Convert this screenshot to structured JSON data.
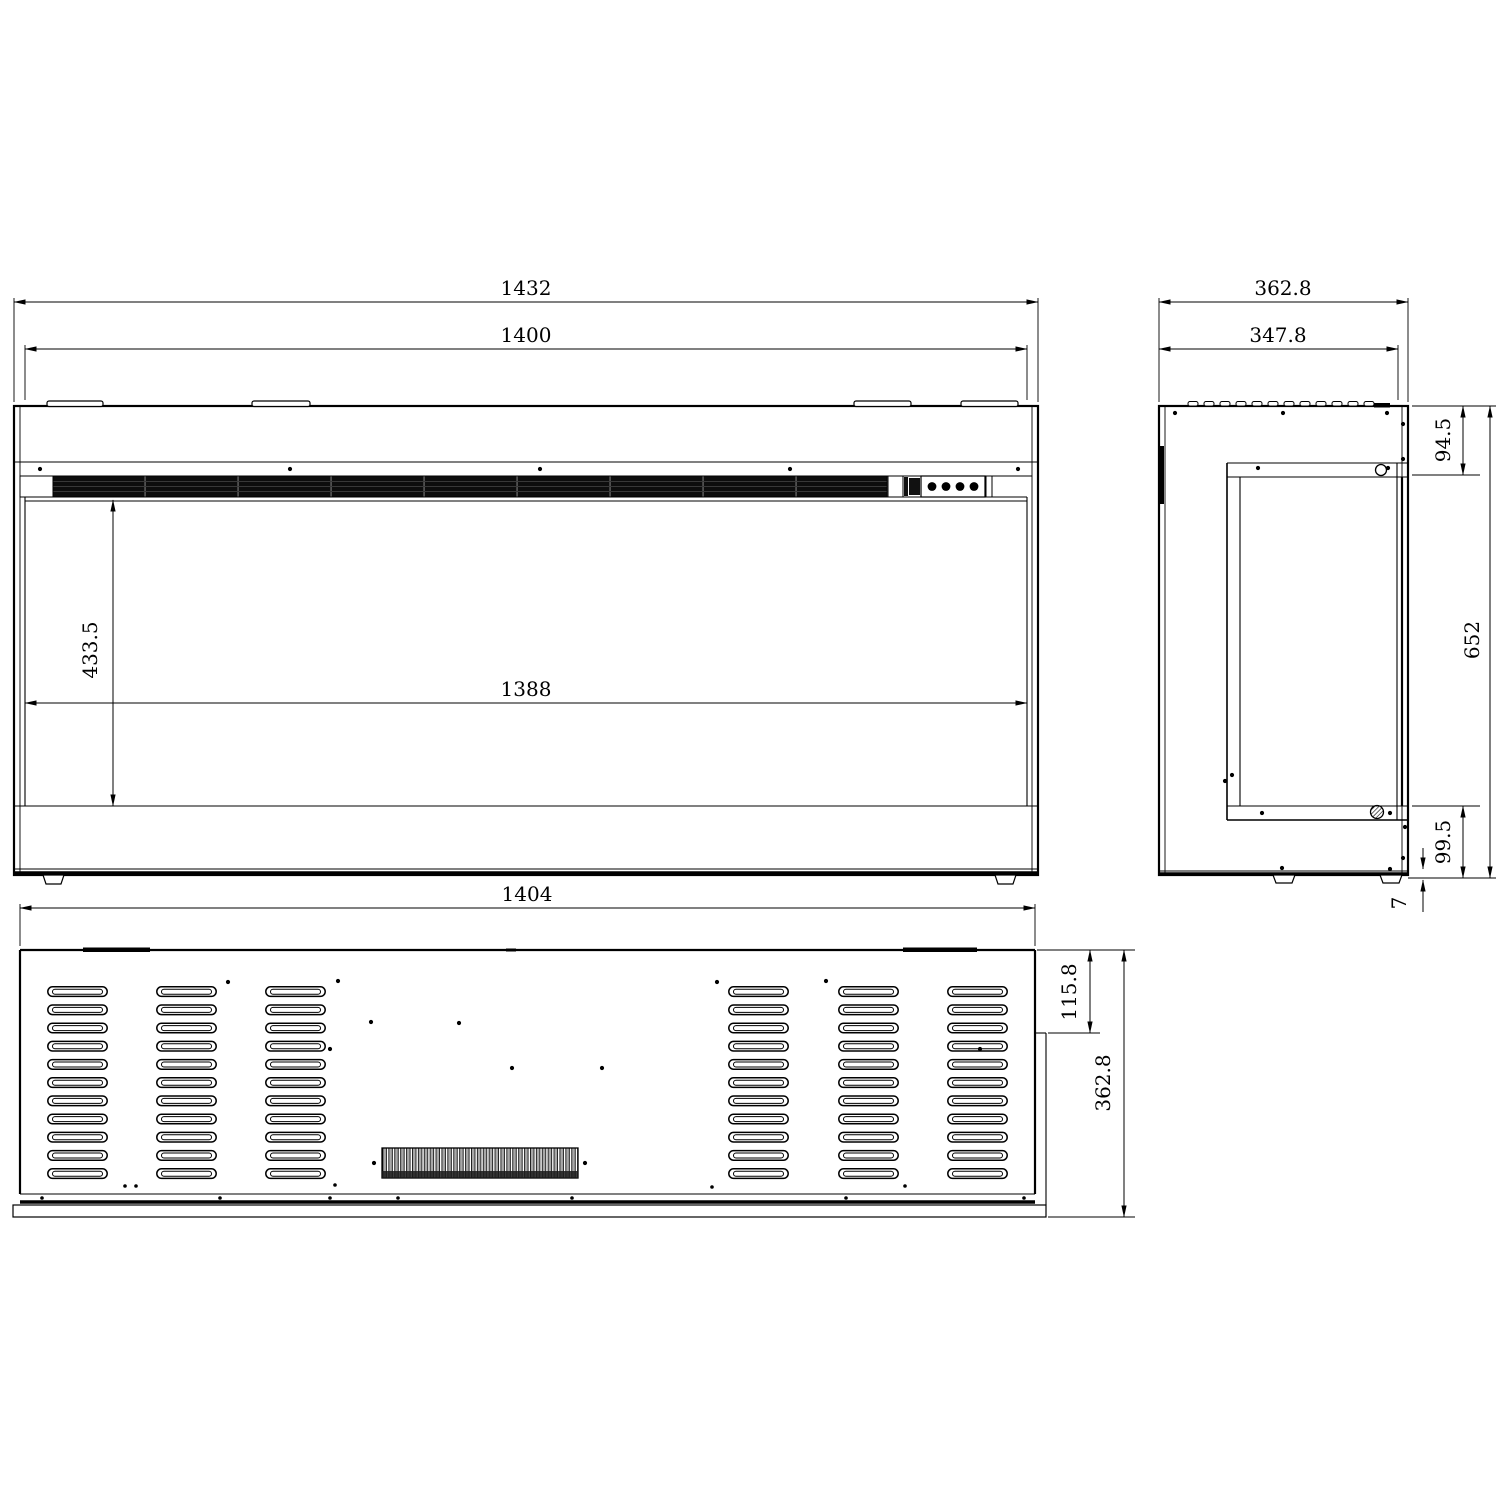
{
  "colors": {
    "background": "#ffffff",
    "lines": "#000000",
    "vent_strip": "#0d0d0d"
  },
  "dims": {
    "front": {
      "overall_width": "1432",
      "inner_width": "1400",
      "opening_height": "433.5",
      "opening_width": "1388"
    },
    "side": {
      "overall_depth": "362.8",
      "top_depth": "347.8",
      "top_section_height": "94.5",
      "overall_height": "652",
      "base_section_height": "99.5",
      "foot_height": "7"
    },
    "rear": {
      "width": "1404",
      "vent_panel_offset": "115.8",
      "depth": "362.8"
    }
  }
}
